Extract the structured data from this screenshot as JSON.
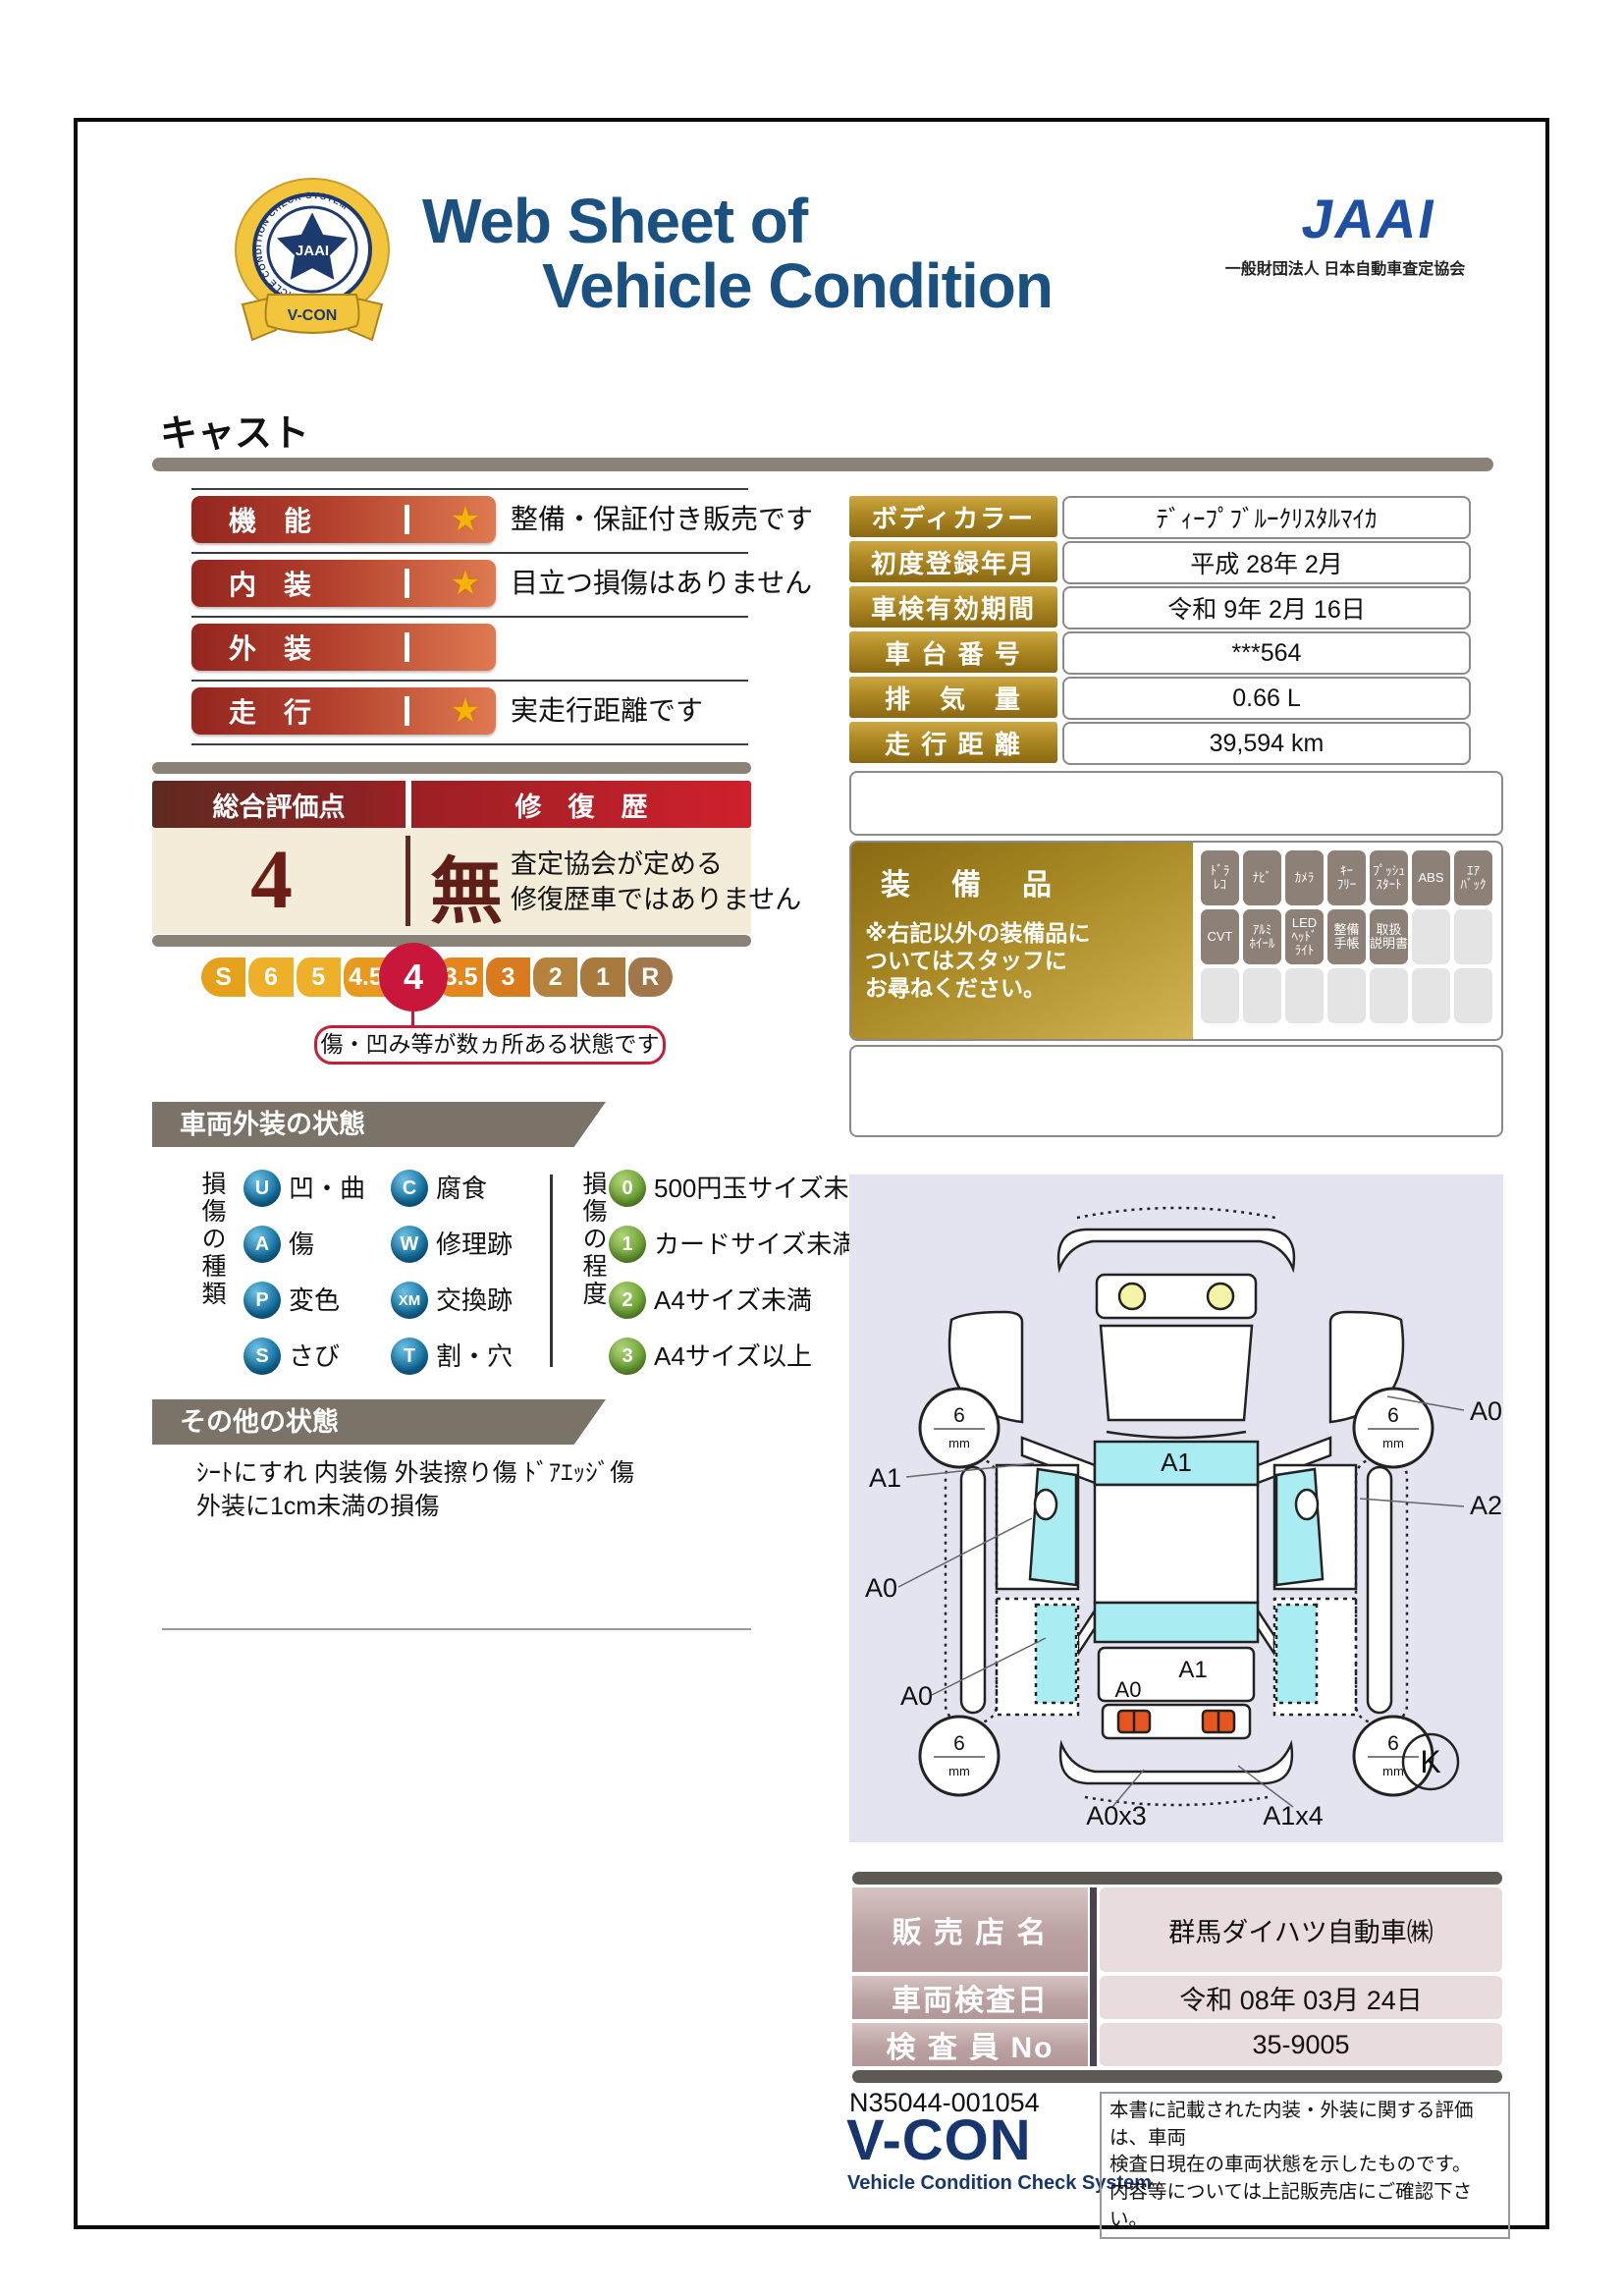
{
  "colors": {
    "title_blue": "#1b5180",
    "jaai_blue": "#1e4fa3",
    "emblem_gold": "#f2c53d",
    "emblem_navy": "#1d3a6e",
    "rating_bar_dark": "#93251f",
    "rating_bar_light": "#e07a51",
    "star_gold": "#f6b40a",
    "beige": "#f3ecd9",
    "score_maroon": "#6b1d16",
    "selected_red": "#c9173b",
    "tab_taupe": "#7b7268",
    "type_circle_blue": "#1270a0",
    "degree_circle_green": "#6ba233",
    "gold_cell": "#b08b25",
    "equip_active": "#8d8076",
    "diagram_bg": "#e4e4f1",
    "diagram_glass_cyan": "#a9edf2",
    "taillight_orange": "#e8541e",
    "dealer_mauve": "#b19797",
    "dealer_value_pink": "#e9dcdc",
    "vcon_navy": "#17356e"
  },
  "header": {
    "emblem_ring_text": "VEHICLE CONDITION CHECK SYSTEM",
    "emblem_center": "JAAI",
    "emblem_banner": "V-CON",
    "title_line1": "Web Sheet of",
    "title_line2": "Vehicle Condition",
    "jaai_wordmark": "JAAI",
    "jaai_subtitle": "一般財団法人 日本自動車査定協会",
    "vehicle_name": "キャスト"
  },
  "ratings": {
    "items": [
      {
        "label": "機　能",
        "star": "★",
        "note": "整備・保証付き販売です"
      },
      {
        "label": "内　装",
        "star": "★",
        "note": "目立つ損傷はありません"
      },
      {
        "label": "外　装",
        "star": "",
        "note": ""
      },
      {
        "label": "走　行",
        "star": "★",
        "note": "実走行距離です"
      }
    ]
  },
  "details": {
    "rows": [
      {
        "label": "ボディカラー",
        "value": "ﾃﾞｨｰﾌﾟﾌﾞﾙｰｸﾘｽﾀﾙﾏｲｶ"
      },
      {
        "label": "初度登録年月",
        "value": "平成 28年 2月"
      },
      {
        "label": "車検有効期間",
        "value": "令和 9年 2月 16日"
      },
      {
        "label": "車 台 番 号",
        "value": "***564"
      },
      {
        "label": "排　気　量",
        "value": "0.66 L"
      },
      {
        "label": "走 行 距 離",
        "value": "39,594 km"
      }
    ]
  },
  "overall": {
    "header_left": "総合評価点",
    "header_right": "修　復　歴",
    "score": "4",
    "repair": "無",
    "repair_note": "査定協会が定める\n修復歴車ではありません",
    "scale": [
      "S",
      "6",
      "5",
      "4.5",
      "4",
      "3.5",
      "3",
      "2",
      "1",
      "R"
    ],
    "selected": "4",
    "callout": "傷・凹み等が数ヵ所ある状態です"
  },
  "equipment": {
    "title": "装　備　品",
    "note": "※右記以外の装備品に\nついてはスタッフに\nお尋ねください。",
    "cells": [
      {
        "label": "ﾄﾞﾗ\nﾚｺ",
        "active": true
      },
      {
        "label": "ﾅﾋﾞ",
        "active": true
      },
      {
        "label": "ｶﾒﾗ",
        "active": true
      },
      {
        "label": "ｷｰ\nﾌﾘｰ",
        "active": true
      },
      {
        "label": "ﾌﾟｯｼｭ\nｽﾀｰﾄ",
        "active": true
      },
      {
        "label": "ABS",
        "active": true
      },
      {
        "label": "ｴｱ\nﾊﾞｯｸ",
        "active": true
      },
      {
        "label": "CVT",
        "active": true
      },
      {
        "label": "ｱﾙﾐ\nﾎｲｰﾙ",
        "active": true
      },
      {
        "label": "LED\nﾍｯﾄﾞ\nﾗｲﾄ",
        "active": true
      },
      {
        "label": "整備\n手帳",
        "active": true
      },
      {
        "label": "取扱\n説明書",
        "active": true
      },
      {
        "label": "",
        "active": false
      },
      {
        "label": "",
        "active": false
      },
      {
        "label": "",
        "active": false
      },
      {
        "label": "",
        "active": false
      },
      {
        "label": "",
        "active": false
      },
      {
        "label": "",
        "active": false
      },
      {
        "label": "",
        "active": false
      },
      {
        "label": "",
        "active": false
      },
      {
        "label": "",
        "active": false
      }
    ]
  },
  "exterior": {
    "tab": "車両外装の状態",
    "type_header": "損傷の種類",
    "types": [
      {
        "code": "U",
        "label": "凹・曲"
      },
      {
        "code": "C",
        "label": "腐食"
      },
      {
        "code": "A",
        "label": "傷"
      },
      {
        "code": "W",
        "label": "修理跡"
      },
      {
        "code": "P",
        "label": "変色"
      },
      {
        "code": "XM",
        "label": "交換跡"
      },
      {
        "code": "S",
        "label": "さび"
      },
      {
        "code": "T",
        "label": "割・穴"
      }
    ],
    "degree_header": "損傷の程度",
    "degrees": [
      {
        "code": "0",
        "label": "500円玉サイズ未満"
      },
      {
        "code": "1",
        "label": "カードサイズ未満"
      },
      {
        "code": "2",
        "label": "A4サイズ未満"
      },
      {
        "code": "3",
        "label": "A4サイズ以上"
      }
    ]
  },
  "other": {
    "tab": "その他の状態",
    "text": "ｼｰﾄにすれ 内装傷 外装擦り傷 ﾄﾞｱｴｯｼﾞ傷\n外装に1cm未満の損傷"
  },
  "diagram": {
    "tire_value": "6",
    "tire_unit": "mm",
    "windshield_label": "A1",
    "tailgate_label": "A1",
    "tailgate_corner_label": "A0",
    "left_labels": [
      "A1",
      "A0",
      "A0"
    ],
    "right_labels": [
      "A0",
      "A2"
    ],
    "bottom_labels": [
      "A0x3",
      "A1x4"
    ],
    "key_mark": "K"
  },
  "dealer": {
    "rows": [
      {
        "label": "販 売 店 名",
        "value": "群馬ダイハツ自動車㈱"
      },
      {
        "label": "車両検査日",
        "value": "令和 08年 03月 24日"
      },
      {
        "label": "検 査 員 No",
        "value": "35-9005"
      }
    ]
  },
  "footer": {
    "doc_number": "N35044-001054",
    "vcon": "V-CON",
    "vcon_sub": "Vehicle Condition Check System",
    "note": "本書に記載された内装・外装に関する評価は、車両\n検査日現在の車両状態を示したものです。\n内容等については上記販売店にご確認下さい。"
  }
}
